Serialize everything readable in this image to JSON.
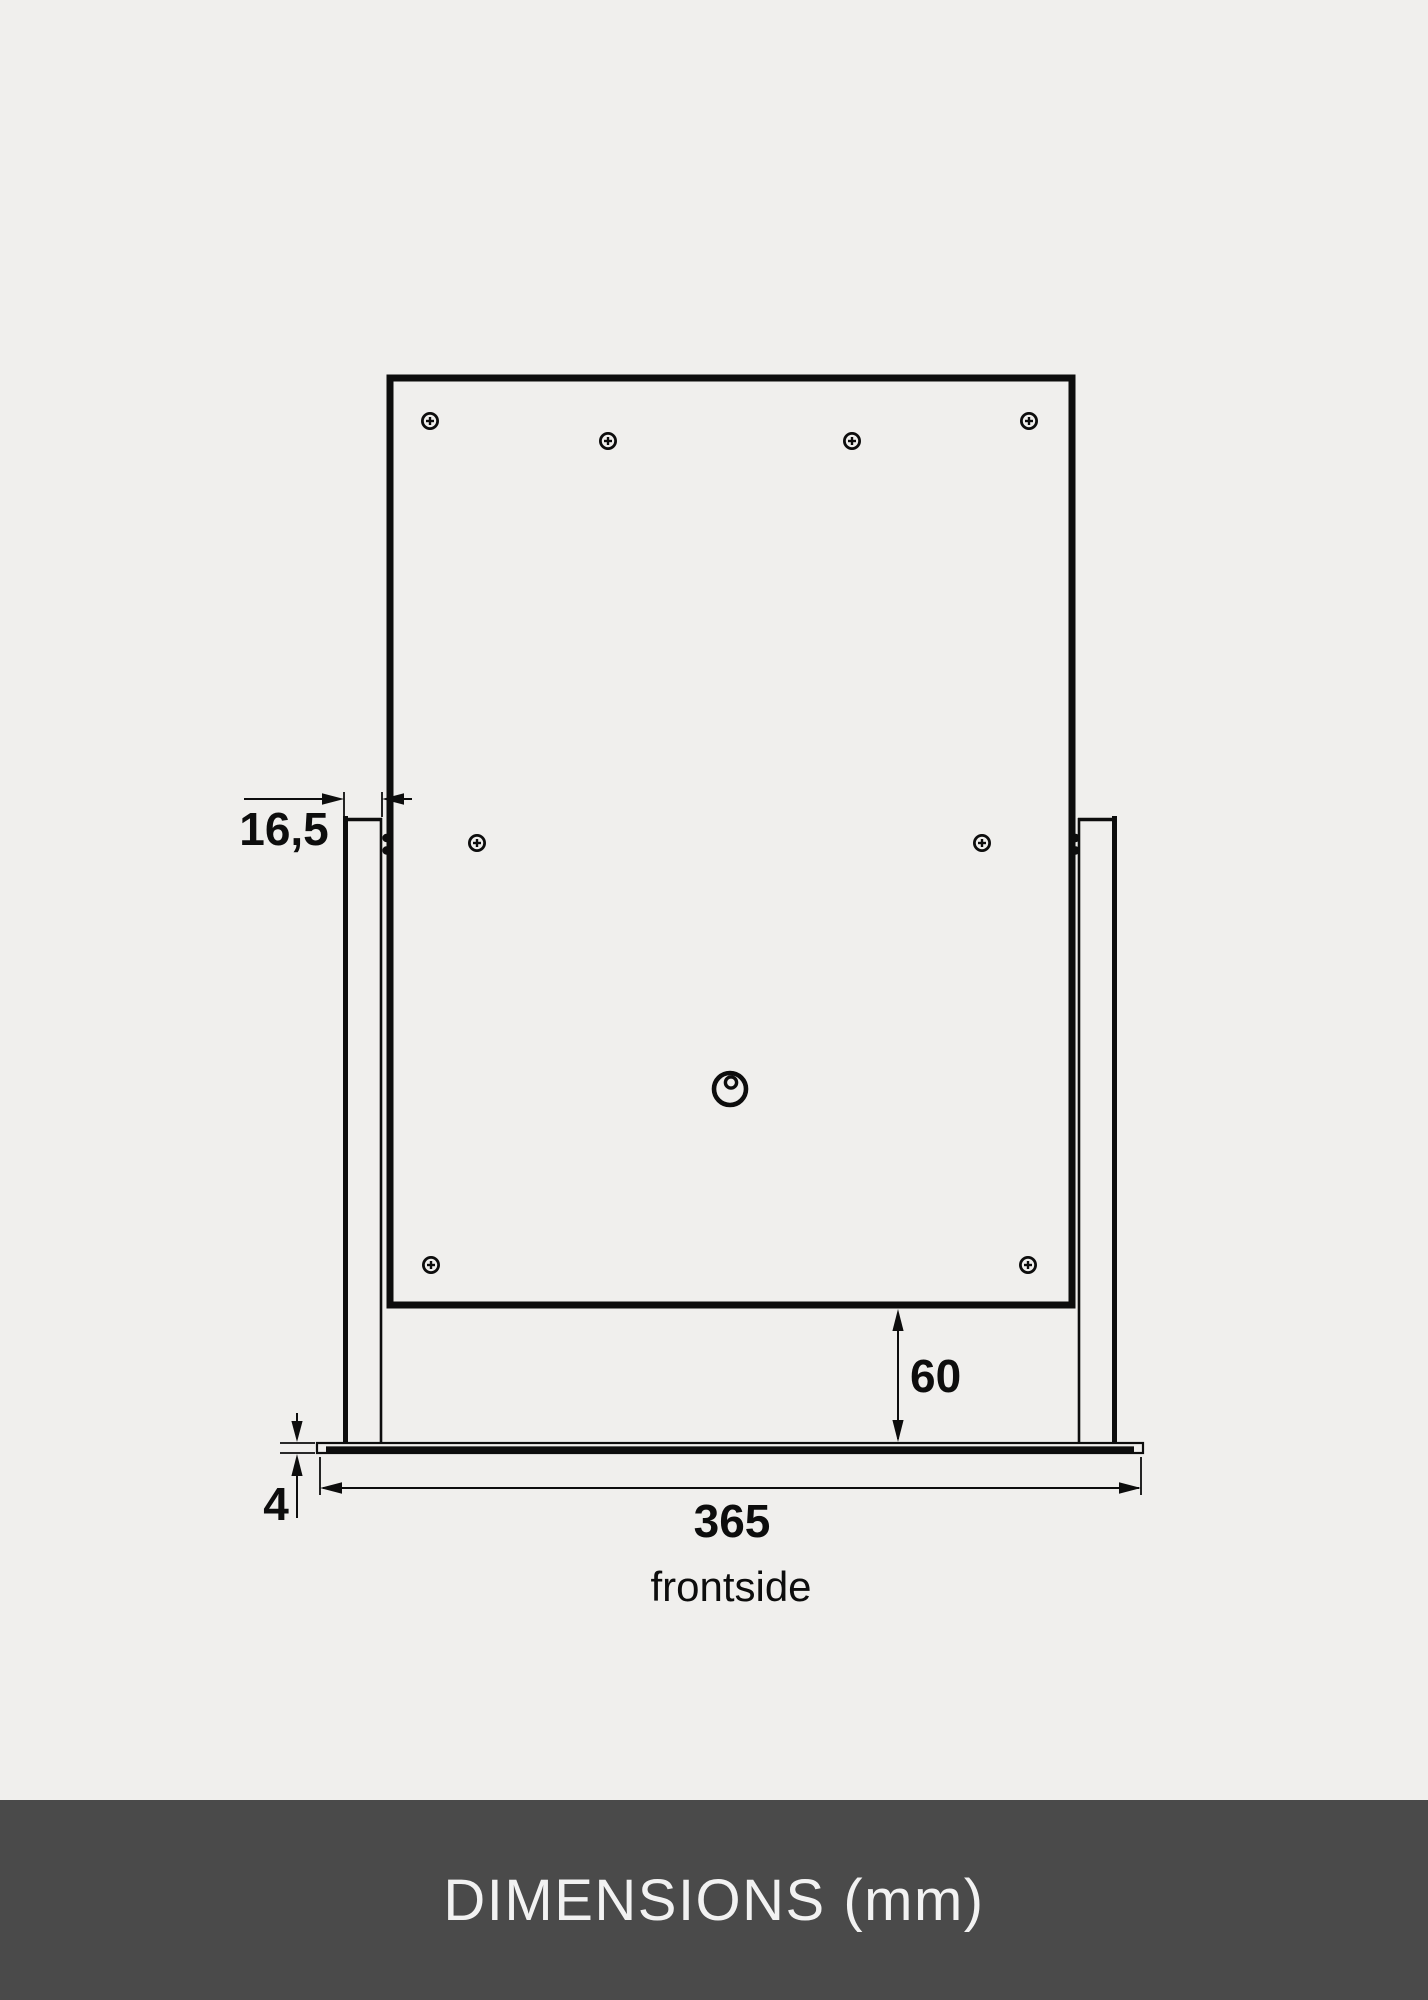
{
  "colors": {
    "background": "#f0efed",
    "line": "#0d0d0d",
    "footer_background": "#4a4a4a",
    "footer_text": "#f2f2f2"
  },
  "drawing": {
    "dims": {
      "leg_thickness": "16,5",
      "panel_to_base_gap": "60",
      "base_plate_thickness": "4",
      "base_plate_width": "365"
    },
    "view_label": "frontside"
  },
  "footer": {
    "title": "DIMENSIONS (mm)"
  }
}
